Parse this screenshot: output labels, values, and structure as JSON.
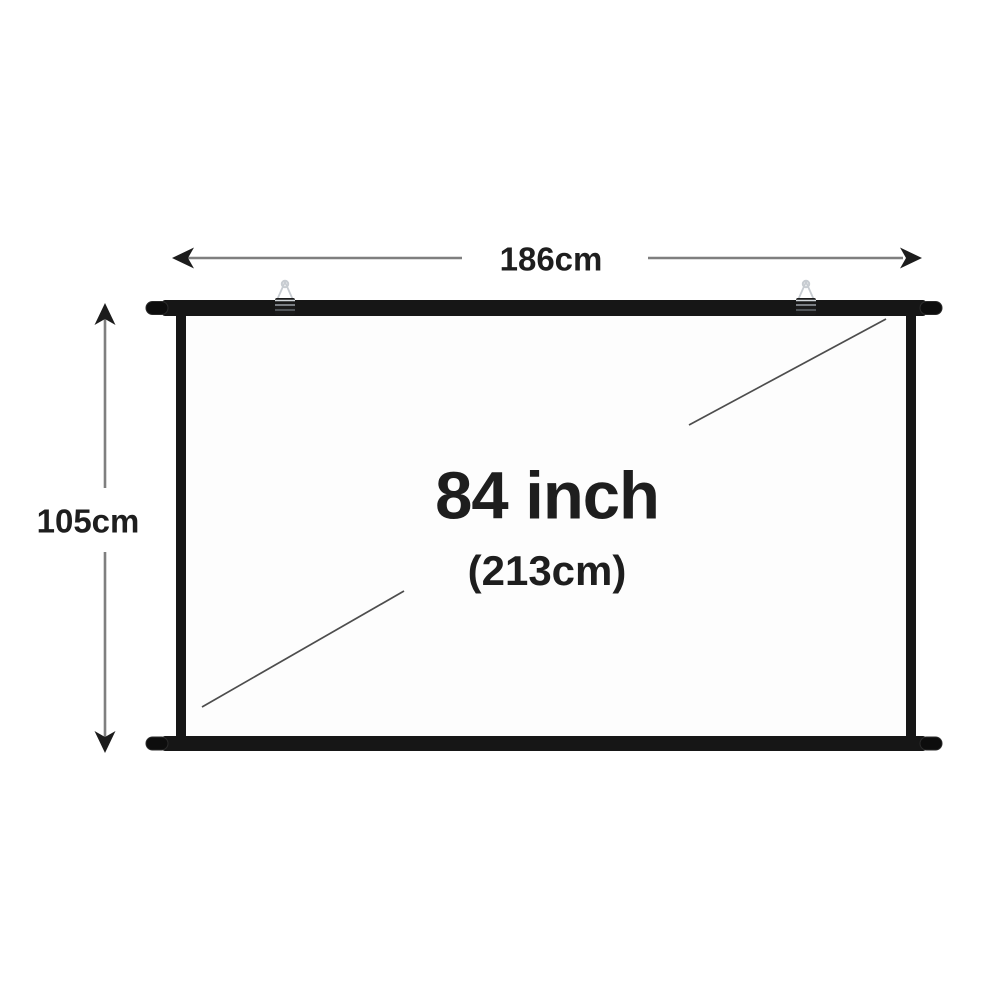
{
  "labels": {
    "width": "186cm",
    "height": "105cm",
    "diagonal_inch": "84 inch",
    "diagonal_cm": "(213cm)"
  },
  "icons": {
    "hook_left": "hanging-hook-icon",
    "hook_right": "hanging-hook-icon"
  },
  "colors": {
    "background": "#ffffff",
    "frame": "#161616",
    "end_cap": "#0d0d0d",
    "screen_surface": "#fdfdfd",
    "arrow_line": "#7f7f7f",
    "arrow_head": "#1c1c1c",
    "diagonal_line": "#4d4d4d",
    "text": "#1e1e1e",
    "hook_metal": "#c7ccd1"
  }
}
